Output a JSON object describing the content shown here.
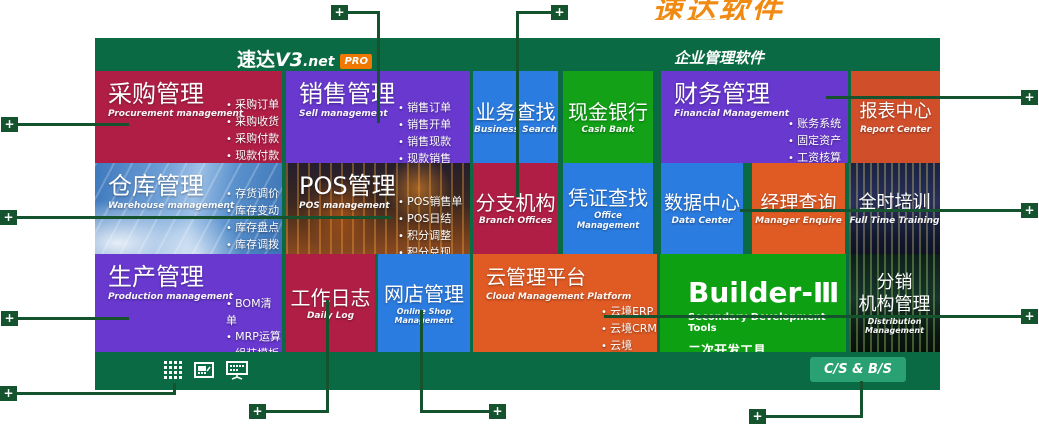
{
  "ui": {
    "plus": "+"
  },
  "banner": {
    "text": "速达软件"
  },
  "header": {
    "logo_cn": "速达",
    "logo_version": "V3",
    "logo_suffix": ".net",
    "pro_badge": "PRO",
    "right_title": "企业管理软件"
  },
  "tiles": {
    "caigou": {
      "title": "采购管理",
      "subtitle": "Procurement management",
      "bullets": [
        "采购订单",
        "采购收货",
        "采购付款",
        "现款付款"
      ]
    },
    "xiaoshou": {
      "title": "销售管理",
      "subtitle": "Sell management",
      "bullets": [
        "销售订单",
        "销售开单",
        "销售现款",
        "现款销售"
      ]
    },
    "yewu": {
      "title": "业务查找",
      "subtitle": "Business Search"
    },
    "xianjin": {
      "title": "现金银行",
      "subtitle": "Cash Bank"
    },
    "caiwu": {
      "title": "财务管理",
      "subtitle": "Financial Management",
      "bullets": [
        "账务系统",
        "固定资产",
        "工资核算"
      ]
    },
    "baobiao": {
      "title": "报表中心",
      "subtitle": "Report Center"
    },
    "cangku": {
      "title": "仓库管理",
      "subtitle": "Warehouse management",
      "bullets": [
        "存货调价",
        "库存变动",
        "库存盘点",
        "库存调拨"
      ]
    },
    "pos": {
      "title": "POS管理",
      "subtitle": "POS management",
      "bullets": [
        "POS销售单",
        "POS日结",
        "积分调整",
        "积分兑现"
      ]
    },
    "fenzhi": {
      "title": "分支机构",
      "subtitle": "Branch Offices"
    },
    "pingzheng": {
      "title": "凭证查找",
      "subtitle": "Office Management"
    },
    "shuju": {
      "title": "数据中心",
      "subtitle": "Data Center"
    },
    "jingli": {
      "title": "经理查询",
      "subtitle": "Manager Enquire"
    },
    "quanshi": {
      "title": "全时培训",
      "subtitle": "Full Time Training"
    },
    "shengchan": {
      "title": "生产管理",
      "subtitle": "Production management",
      "bullets": [
        "BOM清单",
        "MRP运算",
        "组装模板",
        "产品仓库"
      ]
    },
    "gongzuo": {
      "title": "工作日志",
      "subtitle": "Daily Log"
    },
    "wangdian": {
      "title": "网店管理",
      "subtitle": "Online Shop Management"
    },
    "yun": {
      "title": "云管理平台",
      "subtitle": "Cloud Management Platform",
      "bullets": [
        "云境ERP",
        "云境CRM",
        "云境SOHO"
      ]
    },
    "builder": {
      "title": "Builder-Ⅲ",
      "subtitle": "Secondary Development Tools",
      "subtitle2": "二次开发工具"
    },
    "fenxiao": {
      "title_line1": "分销",
      "title_line2": "机构管理",
      "subtitle": "Distribution Management"
    }
  },
  "footer": {
    "cs_bs_label": "C/S & B/S",
    "icons": [
      {
        "name": "modules-grid"
      },
      {
        "name": "screen-chart"
      },
      {
        "name": "network-monitor"
      }
    ]
  },
  "colors": {
    "panel_green": "#0a6a43",
    "callout_green": "#15532f",
    "crimson": "#b01e45",
    "purple": "#6838cf",
    "blue": "#2b7ce0",
    "bright_green": "#12a117",
    "orange_red": "#d14e2b",
    "orange": "#e05a24",
    "pro_orange": "#f07800",
    "banner_orange": "#f08a12",
    "cs_bs_green": "#2aa172"
  }
}
